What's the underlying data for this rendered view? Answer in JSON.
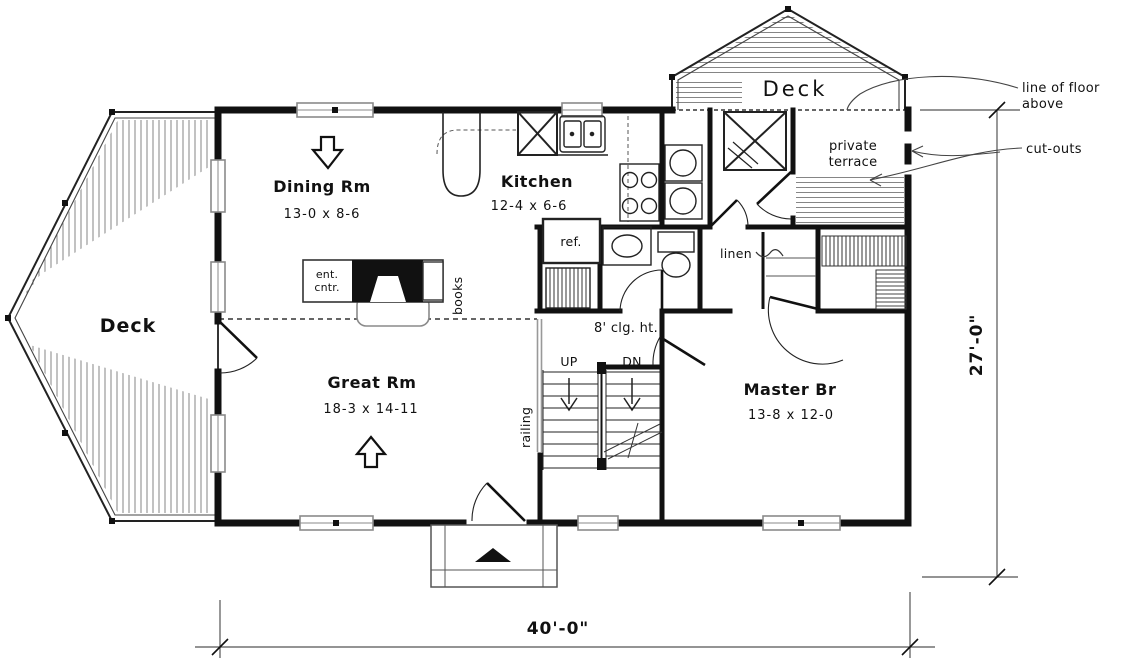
{
  "plan": {
    "rooms": {
      "dining": {
        "name": "Dining Rm",
        "dims": "13-0 x 8-6"
      },
      "kitchen": {
        "name": "Kitchen",
        "dims": "12-4 x 6-6"
      },
      "great": {
        "name": "Great Rm",
        "dims": "18-3 x 14-11"
      },
      "master": {
        "name": "Master Br",
        "dims": "13-8 x 12-0"
      },
      "deck_left": "Deck",
      "deck_top": "Deck",
      "terrace_line1": "private",
      "terrace_line2": "terrace"
    },
    "fixtures": {
      "ref": "ref.",
      "linen": "linen",
      "ent_line1": "ent.",
      "ent_line2": "cntr.",
      "books": "books"
    },
    "stairs": {
      "up": "UP",
      "dn": "DN",
      "railing": "railing",
      "ceiling": "8' clg. ht."
    },
    "dimensions": {
      "width": "40'-0\"",
      "height": "27'-0\""
    },
    "annotations": {
      "floor_line1": "line of floor",
      "floor_line2": "above",
      "cutouts": "cut-outs"
    }
  },
  "colors": {
    "wall": "#111111",
    "thin": "#2b2b2b",
    "gray": "#8a8a8a",
    "paper": "#ffffff"
  }
}
